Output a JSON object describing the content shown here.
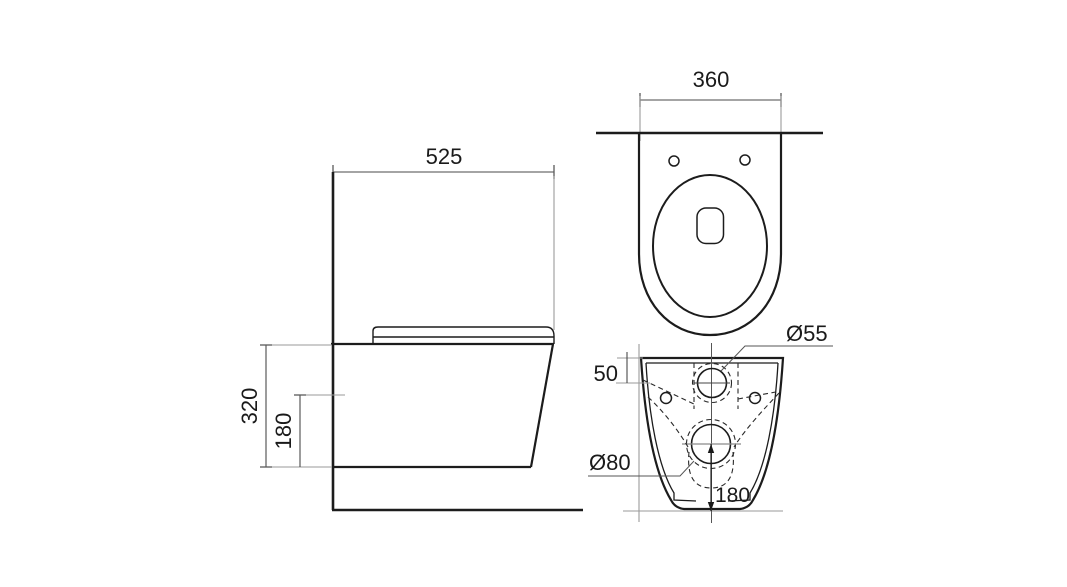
{
  "drawing": {
    "subject": "wall-hung-toilet-dimension-drawing",
    "views": {
      "side_view": {
        "dimensions": {
          "depth": "525",
          "height": "320",
          "lower_height": "180"
        }
      },
      "top_view": {
        "dimensions": {
          "width": "360"
        }
      },
      "rear_view": {
        "dimensions": {
          "inlet_offset": "50",
          "inlet_diameter": "Ø55",
          "outlet_diameter": "Ø80",
          "outlet_height": "180"
        }
      }
    },
    "colors": {
      "background": "#ffffff",
      "outline": "#1c1c1c",
      "dimension_line": "#4a4a4a",
      "extension_line": "#9a9a9a",
      "text": "#1a1a1a"
    }
  }
}
